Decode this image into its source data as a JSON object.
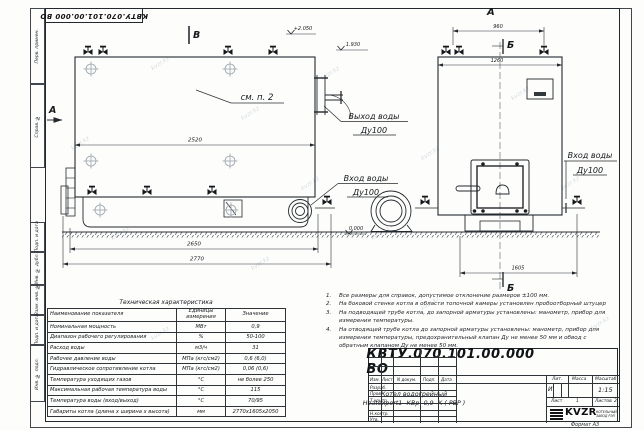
{
  "watermark": "kvzr.kz",
  "frame": {
    "stamp_top": "КВТУ.070.101.00.000  ВО",
    "left_cells": [
      "Перв. примен.",
      "Справ. №",
      "Подп. и дата",
      "Инв. № дубл.",
      "Взам. инв. №",
      "Подп. и дата",
      "Инв. № подл."
    ],
    "format_note": "Формат  А3"
  },
  "drawing": {
    "view_left": {
      "section_b": "В",
      "section_a": "А",
      "elev_plus": "+2.050",
      "elev_mid": "1.930",
      "elev_zero": "0.000",
      "see_note": "см. п. 2",
      "dim_2520": "2520",
      "dim_2650": "2650",
      "dim_2770": "2770",
      "outlet_line1": "Выход воды",
      "outlet_line2": "Ду100",
      "inlet_line1": "Вход воды",
      "inlet_line2": "Ду100"
    },
    "view_right": {
      "view_label": "А",
      "section_b_top": "Б",
      "section_b_bottom": "Б",
      "dim_960": "960",
      "dim_1260": "1260",
      "dim_1605": "1605",
      "inlet_line1": "Вход воды",
      "inlet_line2": "Ду100"
    }
  },
  "notes": {
    "items": [
      {
        "n": "1.",
        "text": "Все размеры для справок, допустимое отклонение размеров ±100 мм."
      },
      {
        "n": "2.",
        "text": "На боковой стенке котла в области топочной камеры установлен пробоотборный штуцер"
      },
      {
        "n": "3.",
        "text": "На  подводящей трубе котла, до запорной арматуры установлены: манометр, прибор для измерения температуры."
      },
      {
        "n": "4.",
        "text": "На отводящей трубе котла до запорной арматуры установлены: манометр, прибор для измерения температуры, предохранительный клапан Ду не менее 50 мм и обвод с обратным клапаном Ду не менее 50 мм."
      }
    ]
  },
  "spec": {
    "title": "Техническая характеристика",
    "headers": [
      "Наименование показателя",
      "Единицы измерения",
      "Значение"
    ],
    "rows": [
      [
        "Номинальная мощность",
        "МВт",
        "0,9"
      ],
      [
        "Диапазон рабочего регулирования",
        "%",
        "50-100"
      ],
      [
        "Расход воды",
        "м3/ч",
        "31"
      ],
      [
        "Рабочее давление воды",
        "МПа (кгс/см2)",
        "0,6 (6,0)"
      ],
      [
        "Гидравлическое сопротивление котла",
        "МПа (кгс/см2)",
        "0,06 (0,6)"
      ],
      [
        "Температура уходящих газов",
        "°С",
        "не более 250"
      ],
      [
        "Максимальная рабочая температура воды",
        "°С",
        "115"
      ],
      [
        "Температура воды (вход/выход)",
        "°С",
        "70/95"
      ],
      [
        "Габариты котла (длина х ширина х высота)",
        "мм",
        "2770х1605х2050"
      ]
    ]
  },
  "titleblock": {
    "designation": "КВТУ.070.101.00.000  ВО",
    "product_line1": "Котел водогрейный",
    "product_line2": "Heatexpert1- КВр -0,9- К ( РВР )",
    "col_izm": "Изм.",
    "col_list": "Лист",
    "col_doc": "N докум.",
    "col_podp": "Подп.",
    "col_data": "Дата",
    "row_razrab": "Разраб.",
    "row_prov": "Пров.",
    "row_tkontr": "Т.контр.",
    "row_nkontr": "Н.контр.",
    "row_utv": "Утв.",
    "lit_label": "Лит.",
    "mass_label": "Масса",
    "scale_label": "Масштаб",
    "lit_value": "И",
    "scale_value": "1:15",
    "sheet_label": "Лист",
    "sheet_value": "1",
    "sheets_label": "Листов",
    "sheets_value": "2",
    "logo_text": "KVZR",
    "logo_sub1": "КОТЕЛЬНЫЙ",
    "logo_sub2": "ЗАВОД РЭП"
  }
}
